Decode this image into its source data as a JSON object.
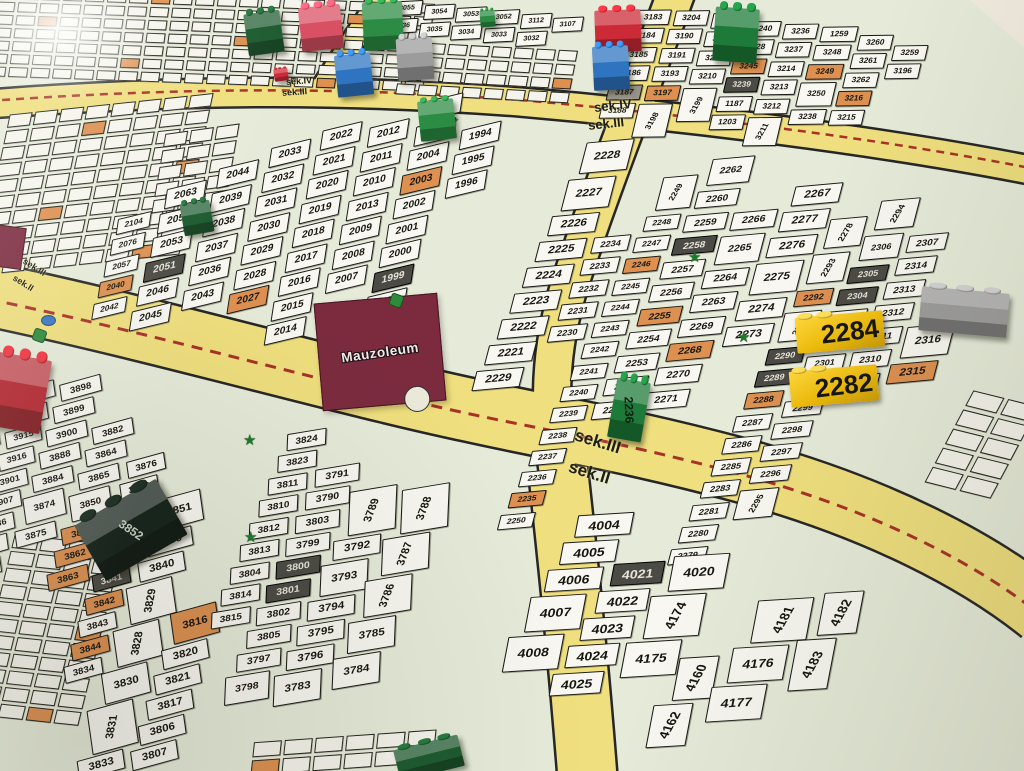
{
  "palette": {
    "map_bg": "#e6ebd9",
    "road": "#efdf7e",
    "road_edge": "#262626",
    "dash_red": "#a83228",
    "plot_white": "#f8f7f1",
    "plot_orange": "#dd9050",
    "plot_dark": "#4b4a44",
    "plot_gray": "#97938a",
    "building": "#7c2b3f",
    "marker_yellow": "#eebc0c"
  },
  "mausoleum": {
    "label": "Mauzoleum"
  },
  "sek_labels": [
    {
      "text": "sek.IV",
      "x": 286,
      "y": 76,
      "fs": 9,
      "rot": -4
    },
    {
      "text": "sek.III",
      "x": 282,
      "y": 87,
      "fs": 9,
      "rot": -4
    },
    {
      "text": "sek.IV",
      "x": 594,
      "y": 98,
      "fs": 13,
      "rot": -6
    },
    {
      "text": "sek.III",
      "x": 588,
      "y": 116,
      "fs": 13,
      "rot": -6
    },
    {
      "text": "sek.III",
      "x": 574,
      "y": 432,
      "fs": 17,
      "rot": 17
    },
    {
      "text": "sek.II",
      "x": 568,
      "y": 463,
      "fs": 17,
      "rot": 17
    },
    {
      "text": "sek.III",
      "x": 22,
      "y": 262,
      "fs": 9,
      "rot": 32
    },
    {
      "text": "sek.II",
      "x": 12,
      "y": 278,
      "fs": 9,
      "rot": 32
    }
  ],
  "roads": [
    {
      "d": "M -12 104 C 200 88 360 90 520 102 C 680 116 880 140 1040 172",
      "w": 27
    },
    {
      "d": "M 388 -12 C 362 28 336 66 318 96",
      "w": 22
    },
    {
      "d": "M 678 -12 C 648 70 600 190 568 290 C 550 350 548 404 558 474 C 568 548 578 664 586 784",
      "w": 36
    },
    {
      "d": "M 558 470 C 568 560 580 680 588 784",
      "w": 58
    },
    {
      "d": "M -12 294 C 160 330 330 380 470 410 C 560 430 620 438 740 470 C 880 508 980 562 1042 612",
      "w": 62
    }
  ],
  "dashes": [
    {
      "d": "M -12 101 C 200 86 360 88 520 100 C 680 114 880 138 1040 170",
      "w": 2.5,
      "da": "8 6"
    },
    {
      "d": "M -12 299 C 160 335 330 384 470 414 C 560 433 620 442 740 474 C 880 512 980 566 1042 616",
      "w": 3,
      "da": "11 8"
    }
  ],
  "blocks": [
    {
      "name": "block-2000",
      "x": 148,
      "y": 118,
      "rot": -6,
      "skew": -22,
      "fs": 10,
      "gap": 4,
      "cgap": 9,
      "pr": -8,
      "cols": [
        {
          "dy": 95,
          "fs": 0.8,
          "p": [
            "2104",
            "2076",
            "2057",
            "2040|o",
            "2042"
          ]
        },
        {
          "dy": 70,
          "p": [
            "2063",
            "2054",
            "2053",
            "2051|d",
            "2046",
            "2045"
          ]
        },
        {
          "dy": 55,
          "p": [
            "2044",
            "2039",
            "2038",
            "2037",
            "2036",
            "2043"
          ]
        },
        {
          "dy": 40,
          "p": [
            "2033",
            "2032",
            "2031",
            "2030",
            "2029",
            "2028",
            "2027|o"
          ]
        },
        {
          "dy": 28,
          "p": [
            "2022",
            "2021",
            "2020",
            "2019",
            "2018",
            "2017",
            "2016",
            "2015",
            "2014"
          ]
        },
        {
          "dy": 30,
          "p": [
            "2012",
            "2011",
            "2010",
            "2013",
            "2009",
            "2008",
            "2007"
          ]
        },
        {
          "dy": 10,
          "p": [
            "2006",
            "2005",
            "2004",
            "2003|o",
            "2002",
            "2001",
            "2000",
            "1999|d",
            "1998",
            "1993|d"
          ]
        },
        {
          "dy": 42,
          "p": [
            "1994",
            "1995",
            "1996"
          ]
        }
      ]
    },
    {
      "name": "block-2200",
      "x": 592,
      "y": 138,
      "rot": 6,
      "skew": -20,
      "fs": 11,
      "gap": 6,
      "cgap": 5,
      "pr": -12,
      "cols": [
        {
          "dy": 0,
          "p": [
            "2228|b",
            "2227|b",
            "2226",
            "2225",
            "2224",
            "2223",
            "2222",
            "2221",
            "2229"
          ]
        },
        {
          "dy": 95,
          "fs": 0.78,
          "p": [
            "2234",
            "2233",
            "2232",
            "2231",
            "2230"
          ]
        },
        {
          "dy": 28,
          "fs": 0.72,
          "p": [
            "2249|bv",
            "2248",
            "2247",
            "2246|o",
            "2245",
            "2244",
            "2243",
            "2242",
            "2241",
            "2240",
            "2239",
            "2238",
            "2237",
            "2236",
            "2235|o",
            "2250"
          ]
        },
        {
          "dy": 4,
          "fs": 0.85,
          "p": [
            "2262|b",
            "2260",
            "2259",
            "2258|d",
            "2257",
            "2256",
            "2255|o",
            "2254",
            "2253",
            "2252",
            "2251"
          ]
        },
        {
          "dy": 55,
          "fs": 0.9,
          "p": [
            "2266",
            "2265|b",
            "2264",
            "2263",
            "2269",
            "2268|o",
            "2270",
            "2271"
          ]
        },
        {
          "dy": 22,
          "p": [
            "2267",
            "2277",
            "2276",
            "2275|b",
            "2274",
            "2273"
          ]
        },
        {
          "dy": 52,
          "fs": 0.78,
          "p": [
            "2278|v",
            "2293|v",
            "2292|o",
            "2291|v",
            "2290|d",
            "2289|d",
            "2288|o",
            "2287",
            "2286",
            "2285",
            "2283",
            "2281",
            "2280",
            "2279"
          ]
        },
        {
          "dy": 28,
          "fs": 0.78,
          "p": [
            "2294|v",
            "2306|b",
            "2305|d",
            "2304|d",
            "2303",
            "2302",
            "2301",
            "2300",
            "2299",
            "2298",
            "2297",
            "2296",
            "2295|v"
          ]
        },
        {
          "dy": 60,
          "fs": 0.85,
          "p": [
            "2307",
            "2314",
            "2313",
            "2312",
            "2311",
            "2310",
            "2309"
          ]
        },
        {
          "dy": 150,
          "p": [
            "2316|b",
            "2315|o"
          ]
        }
      ]
    },
    {
      "name": "block-3100",
      "x": 642,
      "y": 2,
      "rot": 7,
      "skew": -14,
      "fs": 8,
      "gap": 3,
      "cgap": 4,
      "pr": -8,
      "cols": [
        {
          "dy": 6,
          "p": [
            "3183",
            "3184",
            "3185",
            "3186",
            "3187|g",
            "3188"
          ]
        },
        {
          "dy": 2,
          "p": [
            "3204",
            "3190",
            "3191",
            "3193",
            "3197|o",
            "3198|bv"
          ]
        },
        {
          "dy": 0,
          "p": [
            "3205",
            "3206",
            "3207",
            "3210",
            "3199|bv"
          ]
        },
        {
          "dy": 4,
          "p": [
            "3240",
            "3228",
            "3245|o",
            "3239|d",
            "1187",
            "1203"
          ]
        },
        {
          "dy": 2,
          "p": [
            "3236",
            "3237",
            "3214",
            "3213",
            "3212",
            "3211|v"
          ]
        },
        {
          "dy": 0,
          "p": [
            "1259",
            "3248",
            "3249|o",
            "3250|b",
            "3238"
          ]
        },
        {
          "dy": 4,
          "p": [
            "3260",
            "3261",
            "3262",
            "3216|o",
            "3215"
          ]
        },
        {
          "dy": 10,
          "p": [
            "3259",
            "3196"
          ]
        }
      ]
    },
    {
      "name": "block-top-mid",
      "x": 394,
      "y": 0,
      "rot": 3,
      "skew": -12,
      "fs": 7,
      "gap": 3,
      "cgap": 3,
      "pr": -6,
      "cols": [
        {
          "dy": 0,
          "p": [
            "3055",
            "3036"
          ]
        },
        {
          "dy": 2,
          "p": [
            "3054",
            "3035"
          ]
        },
        {
          "dy": 3,
          "p": [
            "3053",
            "3034"
          ]
        },
        {
          "dy": 4,
          "p": [
            "3052",
            "3033"
          ]
        },
        {
          "dy": 6,
          "p": [
            "3112",
            "3032"
          ]
        },
        {
          "dy": 8,
          "p": [
            "3107"
          ]
        }
      ]
    },
    {
      "name": "block-3800",
      "x": -6,
      "y": 352,
      "rot": 7,
      "skew": -10,
      "fs": 11,
      "gap": 5,
      "cgap": 4,
      "pr": -24,
      "cols": [
        {
          "dy": 40,
          "fs": 0.7,
          "p": [
            "3956",
            "3952",
            "3944",
            "3943",
            "3942",
            "3937",
            "3936"
          ]
        },
        {
          "dy": 26,
          "fs": 0.8,
          "p": [
            "3913",
            "3914",
            "3915",
            "3916",
            "3901",
            "3907",
            "3886",
            "3885",
            "3859"
          ]
        },
        {
          "dy": 16,
          "fs": 0.85,
          "p": [
            "3898",
            "3899",
            "3900",
            "3888",
            "3884",
            "3874|b",
            "3875"
          ]
        },
        {
          "dy": 55,
          "fs": 0.85,
          "p": [
            "3882",
            "3864",
            "3865",
            "3850|b",
            "3849|o",
            "3862|o",
            "3863|o"
          ]
        },
        {
          "dy": 85,
          "fs": 0.85,
          "p": [
            "3876",
            "3866",
            "3853",
            "3854|o",
            "3855",
            "3841|d",
            "3842|o",
            "3843",
            "3844|o",
            "3834"
          ]
        },
        {
          "dy": 118,
          "p": [
            "3851|b",
            "3839",
            "3840",
            "3829|v",
            "3828|v",
            "3830|b",
            "3831|bv",
            "3833",
            "3832"
          ]
        },
        {
          "dy": 228,
          "p": [
            "3816|ob",
            "3820",
            "3821",
            "3817",
            "3806",
            "3807"
          ]
        }
      ]
    },
    {
      "name": "block-3790",
      "x": 292,
      "y": 428,
      "rot": 9,
      "skew": -14,
      "fs": 11,
      "gap": 5,
      "cgap": 4,
      "pr": -20,
      "cols": [
        {
          "dy": 0,
          "fs": 0.85,
          "p": [
            "3824",
            "3823",
            "3811",
            "3810",
            "3812",
            "3813",
            "3804",
            "3814",
            "3815"
          ]
        },
        {
          "dy": 30,
          "fs": 0.9,
          "p": [
            "3791",
            "3790",
            "3803",
            "3799",
            "3800|d",
            "3801|d",
            "3802",
            "3805",
            "3797",
            "3798|b"
          ]
        },
        {
          "dy": 45,
          "p": [
            "3789|bv",
            "3792",
            "3793|b",
            "3794",
            "3795",
            "3796",
            "3783|b"
          ]
        },
        {
          "dy": 35,
          "p": [
            "3788|bv",
            "3787|v",
            "3786|v",
            "3785|b",
            "3784|b"
          ]
        }
      ]
    },
    {
      "name": "block-4000",
      "x": 585,
      "y": 508,
      "rot": 13,
      "skew": -16,
      "fs": 13,
      "gap": 6,
      "cgap": 5,
      "pr": -18,
      "cols": [
        {
          "dy": 0,
          "p": [
            "4004",
            "4005",
            "4006",
            "4007|b",
            "4008|b"
          ]
        },
        {
          "dy": 40,
          "p": [
            "4021|d",
            "4022",
            "4023",
            "4024",
            "4025"
          ]
        },
        {
          "dy": 18,
          "p": [
            "4020|b",
            "4174|v",
            "4175|b"
          ]
        },
        {
          "dy": 118,
          "p": [
            "4160|v",
            "4162|v"
          ]
        },
        {
          "dy": 42,
          "p": [
            "4181|v",
            "4176|b",
            "4177|b"
          ]
        },
        {
          "dy": 22,
          "p": [
            "4182|v",
            "4183|bv"
          ]
        }
      ]
    }
  ],
  "symbols": {
    "stars": [
      {
        "x": 688,
        "y": 250
      },
      {
        "x": 737,
        "y": 330
      },
      {
        "x": 243,
        "y": 433
      },
      {
        "x": 244,
        "y": 530
      },
      {
        "x": 446,
        "y": 114
      }
    ],
    "trees": [
      {
        "x": 390,
        "y": 294
      },
      {
        "x": 33,
        "y": 329
      }
    ],
    "water": [
      {
        "x": 41,
        "y": 315
      }
    ],
    "crosses": [
      {
        "x": 300,
        "y": 24
      }
    ]
  },
  "pieces": [
    {
      "name": "brick-dark-green",
      "c": "#1c5a2e",
      "x": 246,
      "y": 12,
      "w": 36,
      "h": 42,
      "r": -8
    },
    {
      "name": "brick-crimson",
      "c": "#d94f63",
      "x": 300,
      "y": 6,
      "w": 42,
      "h": 44,
      "r": -6
    },
    {
      "name": "brick-green",
      "c": "#2c8c43",
      "x": 363,
      "y": 2,
      "w": 40,
      "h": 48,
      "r": -3
    },
    {
      "name": "brick-blue",
      "c": "#2f74c0",
      "x": 336,
      "y": 54,
      "w": 36,
      "h": 42,
      "r": -6
    },
    {
      "name": "brick-gray",
      "c": "#9c9c9c",
      "x": 397,
      "y": 38,
      "w": 36,
      "h": 42,
      "r": -4
    },
    {
      "name": "brick-green",
      "c": "#2c8c43",
      "x": 419,
      "y": 100,
      "w": 36,
      "h": 40,
      "r": -6
    },
    {
      "name": "brick-red",
      "c": "#cc2a36",
      "x": 595,
      "y": 10,
      "w": 46,
      "h": 42,
      "r": -2
    },
    {
      "name": "brick-blue",
      "c": "#2f74c0",
      "x": 593,
      "y": 46,
      "w": 36,
      "h": 44,
      "r": -3
    },
    {
      "name": "brick-green-tall",
      "c": "#1d7a38",
      "x": 714,
      "y": 8,
      "w": 44,
      "h": 54,
      "r": 4
    },
    {
      "name": "brick-dark-green-small",
      "c": "#1c5a2e",
      "x": 182,
      "y": 202,
      "w": 30,
      "h": 32,
      "r": -10
    },
    {
      "name": "brick-green-2236",
      "c": "#1d7a38",
      "x": 612,
      "y": 380,
      "w": 34,
      "h": 60,
      "r": 10,
      "label": "2236",
      "lrot": 78,
      "lcol": "#0b1f10"
    },
    {
      "name": "brick-black-3852",
      "c": "#15231b",
      "x": 84,
      "y": 498,
      "w": 94,
      "h": 64,
      "r": -30,
      "label": "3852",
      "lrot": 64,
      "lcol": "#c8d4c4"
    },
    {
      "name": "brick-red-edge",
      "c": "#b5252f",
      "x": -8,
      "y": 356,
      "w": 54,
      "h": 74,
      "r": 10
    },
    {
      "name": "brick-gray-wide",
      "c": "#9c9c9c",
      "x": 920,
      "y": 290,
      "w": 88,
      "h": 44,
      "r": 5
    },
    {
      "name": "brick-dark-green-bottom",
      "c": "#1c5a2e",
      "x": 396,
      "y": 742,
      "w": 66,
      "h": 32,
      "r": -14
    },
    {
      "name": "brick-red-tiny",
      "c": "#cc2a36",
      "x": 274,
      "y": 68,
      "w": 14,
      "h": 13,
      "r": -8
    },
    {
      "name": "brick-green-tiny",
      "c": "#2c8c43",
      "x": 480,
      "y": 10,
      "w": 15,
      "h": 17,
      "r": -5
    }
  ],
  "yellow_markers": [
    {
      "n": "2284",
      "x": 796,
      "y": 314,
      "r": -5
    },
    {
      "n": "2282",
      "x": 790,
      "y": 368,
      "r": -5
    }
  ]
}
